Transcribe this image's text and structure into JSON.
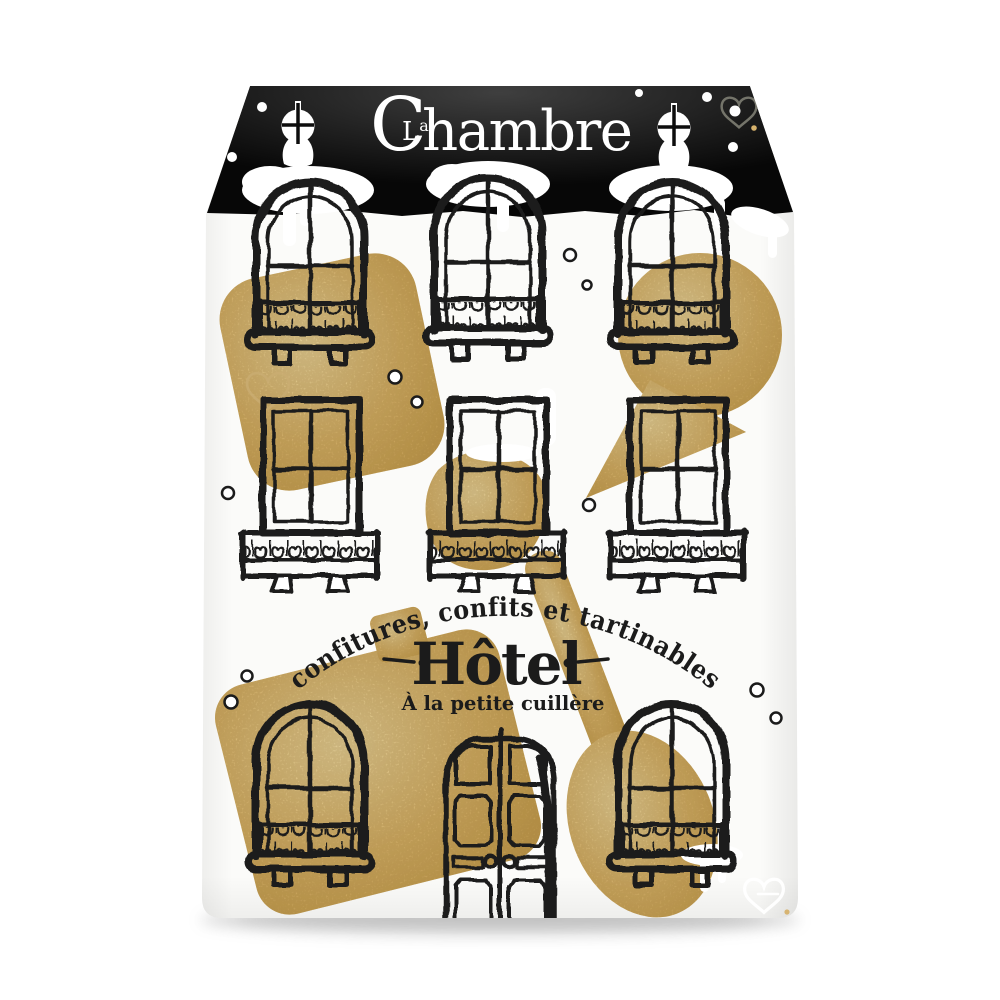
{
  "package": {
    "brand_prefix": "La",
    "brand_prefix_parts": {
      "l": "L",
      "a": "a"
    },
    "brand_name": "Chambre",
    "brand_name_parts": {
      "c": "C",
      "rest": "hambre"
    },
    "arc_tagline": "confitures, confits et tartinables",
    "product_name": "Hôtel",
    "subtitle": "À la petite cuillère"
  },
  "colors": {
    "page_bg": "#ffffff",
    "paper": "#fbfbf9",
    "roof_black": "#070707",
    "roof_highlight": "#3f3f3f",
    "ink": "#1b1b1b",
    "gold": "#d6b26c",
    "gold_light": "#ecd9a2",
    "gold_dark": "#c0994f",
    "white": "#ffffff",
    "heart_outline_top": "#74746a",
    "gold_watermark": "#c9ad72"
  },
  "icons": {
    "keyhole": "keyhole-icon",
    "heart_top": "heart-outline-icon",
    "heart_bottom": "heart-outline-icon",
    "gold_heart": "heart-watermark-icon"
  },
  "illustration": {
    "style": "hand-drawn ink hotel facade on paper pouch, black roof, snow, gold foil",
    "top_row": "3 arched windows with balconies",
    "middle_row": "3 rectangular windows with balconies",
    "bottom_row": "2 arched windows flanking a double front door",
    "accents": "gold foil splashes and a gold spoon silhouette"
  }
}
